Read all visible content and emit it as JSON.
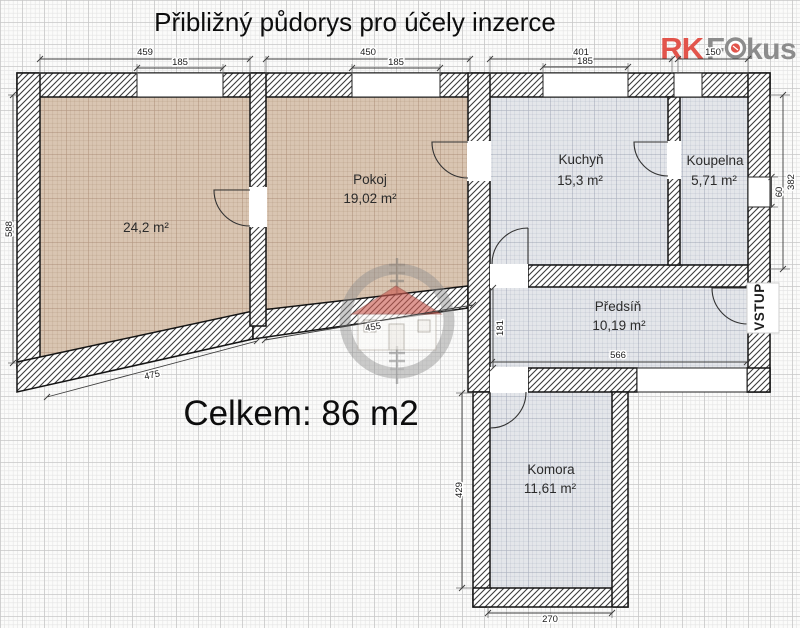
{
  "title": "Přibližný půdorys pro účely inzerce",
  "total": "Celkem: 86 m2",
  "entrance": "VSTUP",
  "logo": {
    "rk": "RK",
    "f": "F",
    "kus": "kus"
  },
  "rooms": [
    {
      "name": "",
      "area": "24,2 m²"
    },
    {
      "name": "Pokoj",
      "area": "19,02 m²"
    },
    {
      "name": "Kuchyň",
      "area": "15,3 m²"
    },
    {
      "name": "Koupelna",
      "area": "5,71 m²"
    },
    {
      "name": "Předsíň",
      "area": "10,19 m²"
    },
    {
      "name": "Komora",
      "area": "11,61 m²"
    }
  ],
  "dims": [
    "459",
    "185",
    "450",
    "185",
    "401",
    "185",
    "150",
    "588",
    "382",
    "60",
    "475",
    "455",
    "181",
    "566",
    "429",
    "270"
  ],
  "colors": {
    "logo_red": "#e2544b",
    "logo_gray": "#8c8c8c",
    "room_tan": "#d9c5b2",
    "room_gray": "#e4e6ea",
    "wall_hatch": "#3c3c3c",
    "watermark_roof": "#cb5a50"
  }
}
